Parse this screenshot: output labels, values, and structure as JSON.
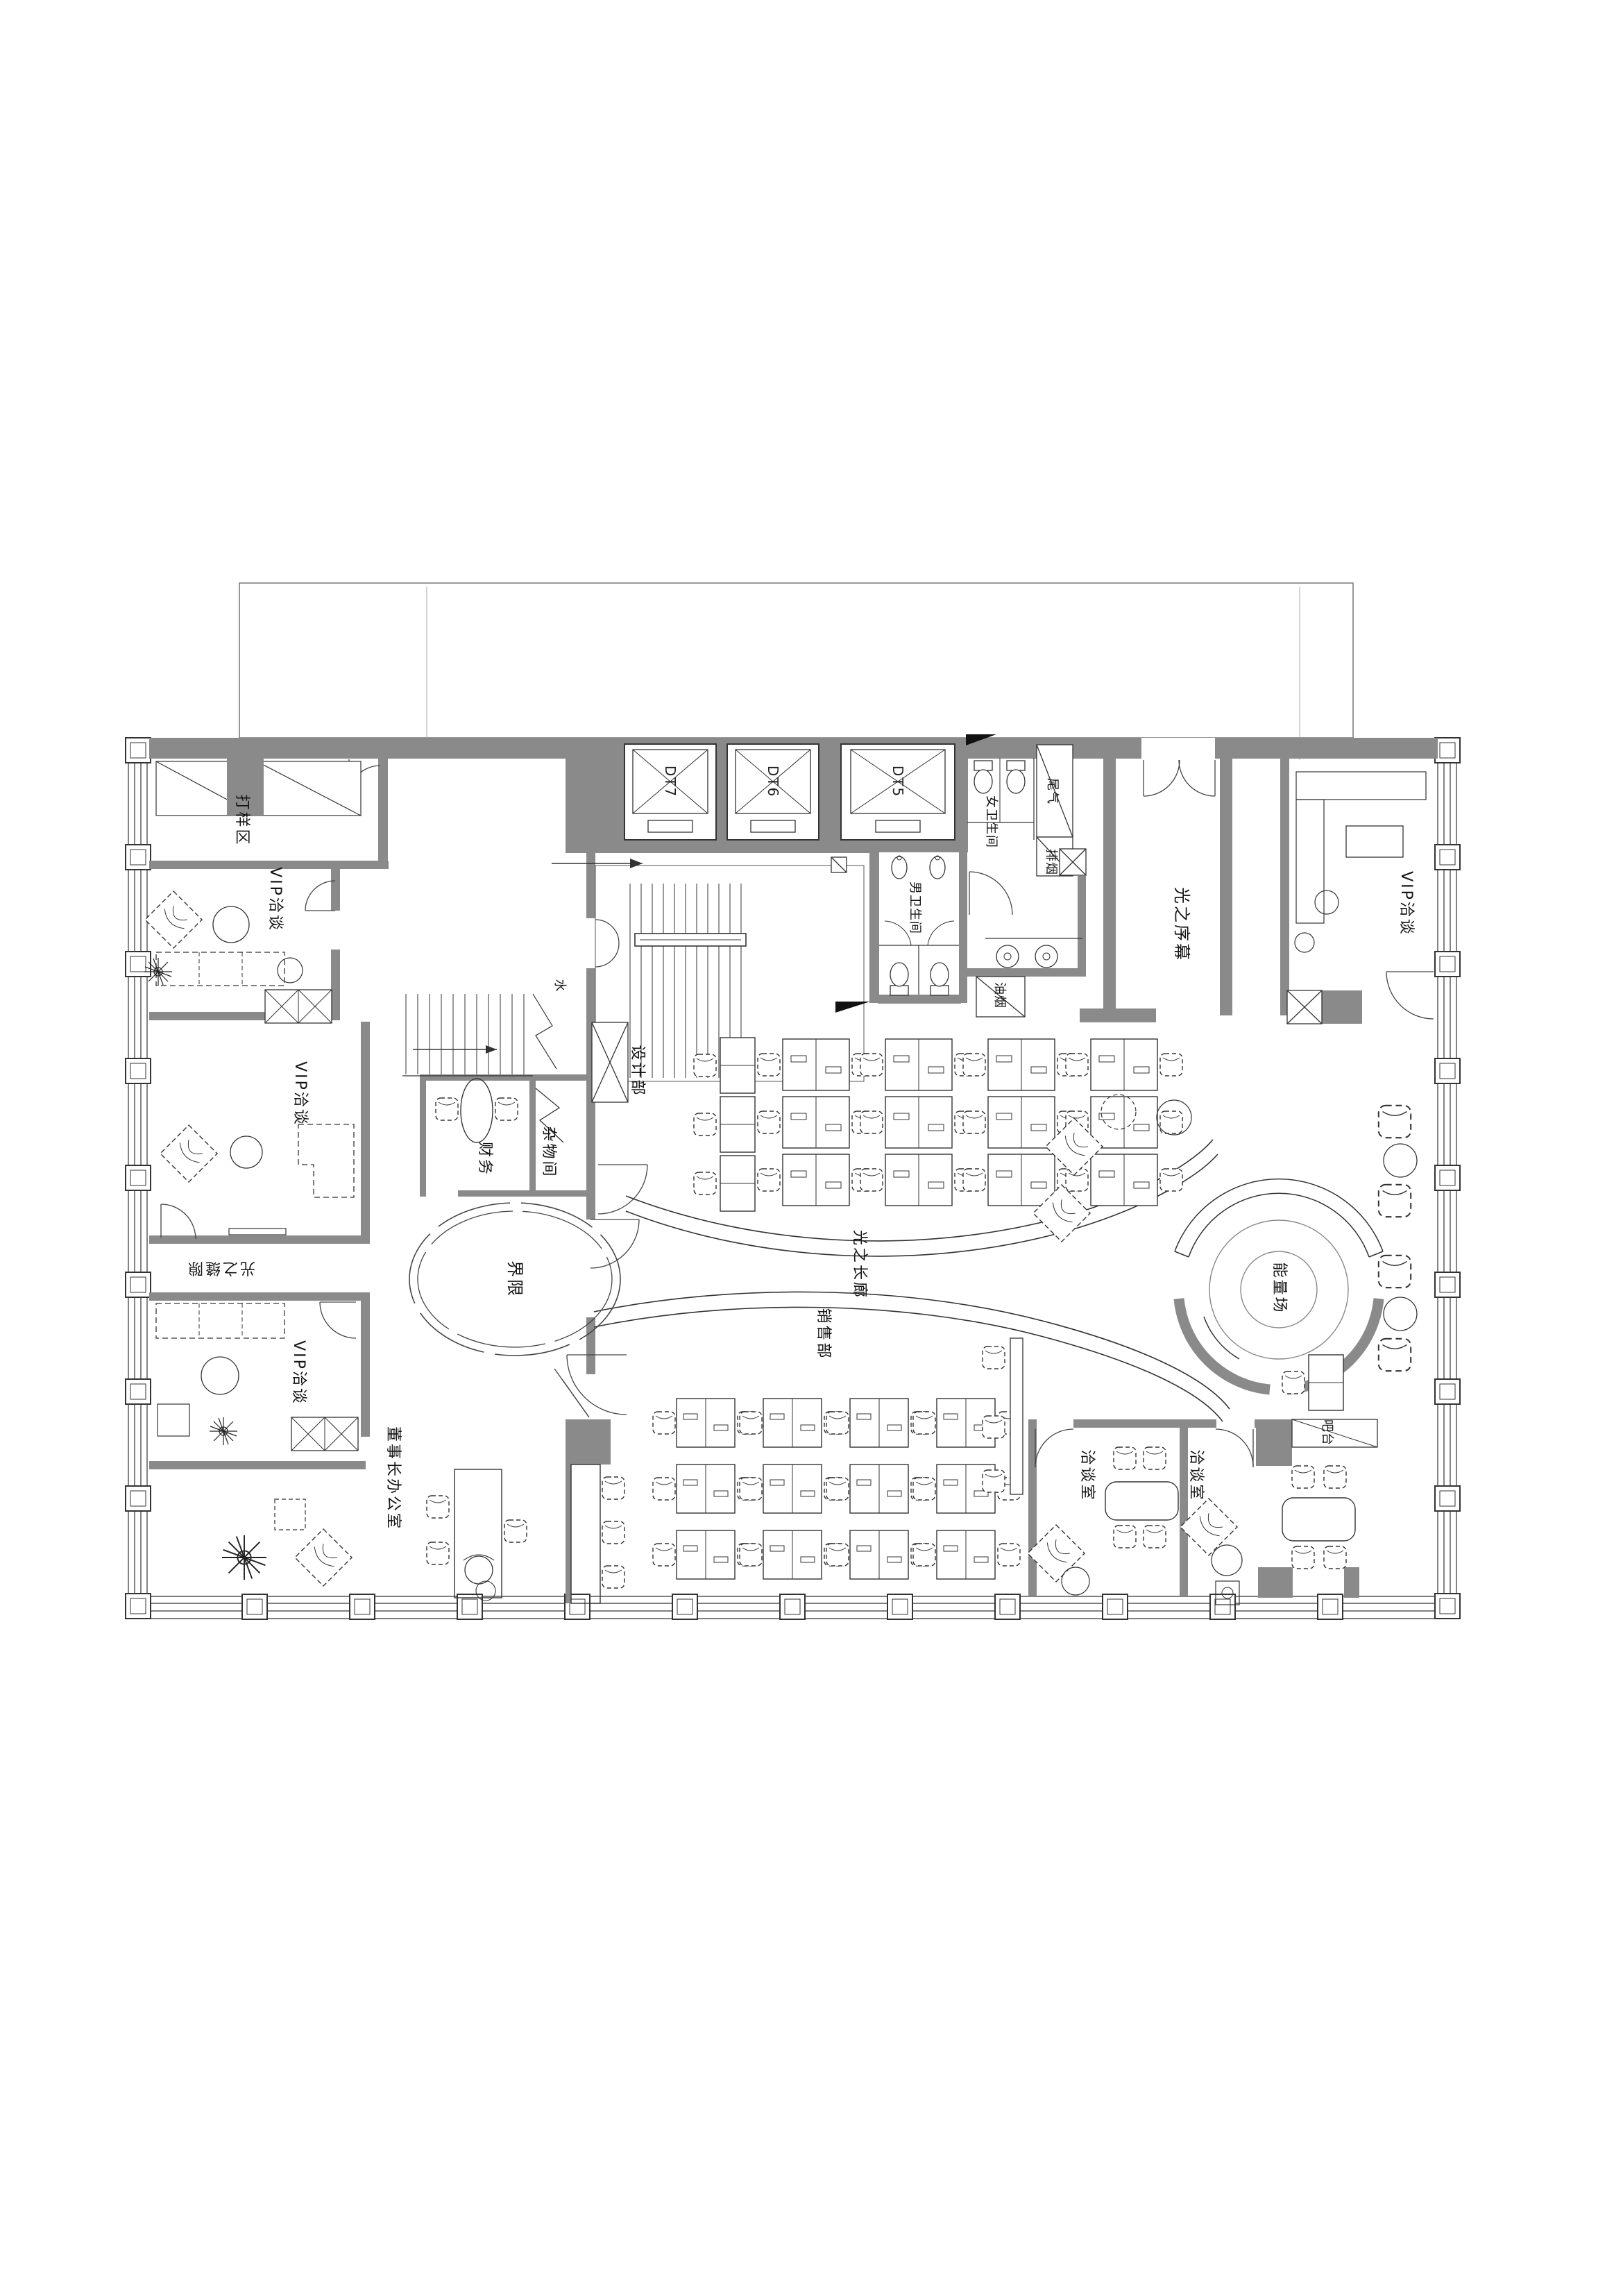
{
  "drawing": {
    "type": "architectural floor plan",
    "style": "CAD black-line on white with grey walls"
  },
  "colors": {
    "wall": "#8a8a8a",
    "line": "#2e2e2e",
    "background": "#ffffff"
  },
  "labels": {
    "sample_area": "打样区",
    "vip_talk_1": "VIP洽谈",
    "vip_talk_2": "VIP洽谈",
    "vip_talk_3": "VIP洽谈",
    "vip_talk_right": "VIP洽谈",
    "finance": "财务",
    "storage": "杂物间",
    "design_dept": "设计部",
    "sales_dept": "销售部",
    "chairman_office": "董事长办公室",
    "meeting_room_1": "洽谈室",
    "meeting_room_2": "洽谈室",
    "bar_counter": "吧台",
    "mens_restroom": "男卫生间",
    "womens_restroom": "女卫生间",
    "exhaust_shaft": "尾气",
    "smoke_shaft": "排烟",
    "fume_shaft": "油烟",
    "water_shaft": "水",
    "light_prologue": "光之序幕",
    "light_corridor": "光之长廊",
    "light_crevice": "光之缝隙",
    "boundary": "界限",
    "energy_field": "能量场"
  },
  "elevators": [
    {
      "id": "DT7"
    },
    {
      "id": "DT6"
    },
    {
      "id": "DT5"
    }
  ]
}
